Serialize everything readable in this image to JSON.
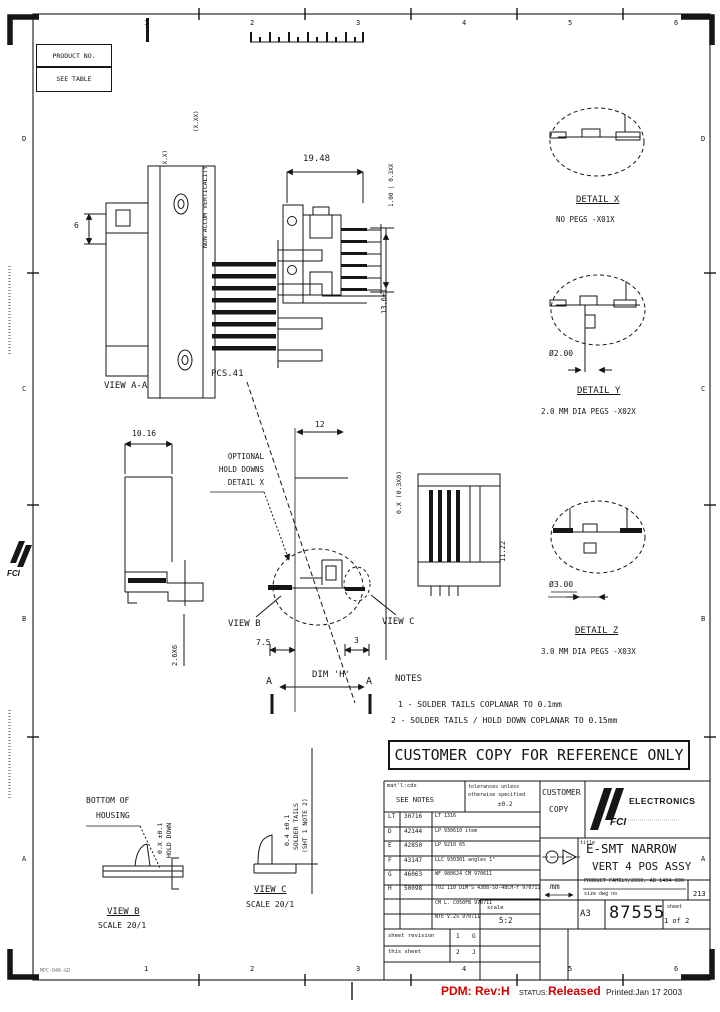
{
  "colors": {
    "ink": "#161616",
    "red": "#d40000"
  },
  "corner_boxes": {
    "product_no": "PRODUCT NO.",
    "see_table": "SEE TABLE"
  },
  "zones": {
    "top": [
      "1",
      "2",
      "3",
      "4",
      "5",
      "6"
    ],
    "bottom": [
      "1",
      "2",
      "3",
      "4",
      "5",
      "6"
    ],
    "left": [
      "D",
      "C",
      "B",
      "A"
    ],
    "right": [
      "D",
      "C",
      "B",
      "A"
    ]
  },
  "views": {
    "view_aa": {
      "label": "VIEW A-A",
      "pcs_label": "PCS.41",
      "dim_height": "6",
      "vdim_a": "(X.X)",
      "vdim_b": "(X.XX)",
      "vertical_note": "NON ACCUM VERTICALITY",
      "tail_dim": "0.X (0.3X0)"
    },
    "front": {
      "dim_width": "19.48",
      "vdim_top": "1.00 | 0.3XX",
      "vdim_side": "13.6±1"
    },
    "profile": {
      "dim_top": "10.16",
      "vdim_bottom": "2.6X6"
    },
    "section": {
      "dim_top": "12",
      "optional_1": "OPTIONAL",
      "optional_2": "HOLD DOWNS",
      "optional_3": "DETAIL X",
      "view_b_ref": "VIEW B",
      "view_c_ref": "VIEW C",
      "dim_left": "7.5",
      "dim_right": "3",
      "dim_h": "DIM 'H'",
      "section_letter": "A"
    },
    "right_view": {
      "vdim": "11.22"
    }
  },
  "details": [
    {
      "name": "DETAIL X",
      "sub": "NO PEGS  -X01X",
      "dim": ""
    },
    {
      "name": "DETAIL Y",
      "sub": "2.0 MM DIA PEGS -X02X",
      "dim": "Ø2.00"
    },
    {
      "name": "DETAIL Z",
      "sub": "3.0 MM DIA PEGS -X03X",
      "dim": "Ø3.00"
    }
  ],
  "notes": {
    "title": "NOTES",
    "items": [
      "1 - SOLDER TAILS COPLANAR TO 0.1mm",
      "2 - SOLDER TAILS / HOLD DOWN COPLANAR TO 0.15mm"
    ]
  },
  "banner": "CUSTOMER COPY FOR REFERENCE ONLY",
  "bottom_views": {
    "view_b": {
      "callout_1": "BOTTOM OF",
      "callout_2": "HOUSING",
      "vdim": "0.X ±0.1",
      "vlabel": "HOLD DOWN",
      "label": "VIEW B",
      "scale": "SCALE 20/1"
    },
    "view_c": {
      "vdim": "0.4 ±0.1",
      "vlabel_1": "SOLDER TAILS",
      "vlabel_2": "(SHT 1 NOTE 2)",
      "label": "VIEW C",
      "scale": "SCALE 20/1"
    }
  },
  "title_block": {
    "matl_label": "mat'l:cds",
    "see_notes": "SEE NOTES",
    "tol_1": "tolerances unless",
    "tol_2": "otherwise specified",
    "tol_value": "±0.2",
    "revisions": [
      {
        "ltr": "LT",
        "ecn": "30716",
        "desc": "LT 1316"
      },
      {
        "ltr": "D",
        "ecn": "42144",
        "desc": "LP 930610  item"
      },
      {
        "ltr": "E",
        "ecn": "42850",
        "desc": "LP 9210 65"
      },
      {
        "ltr": "F",
        "ecn": "43147",
        "desc": "LLC 930301  angles  1°"
      },
      {
        "ltr": "G",
        "ecn": "46063",
        "desc": "WF 980624 CM  970611"
      },
      {
        "ltr": "H",
        "ecn": "50098",
        "desc": "T02 110 DIM'S 4308-SO-48CH-F 970711"
      },
      {
        "ltr": "",
        "ecn": "",
        "desc": "CM  L. C050FB  970711"
      },
      {
        "ltr": "",
        "ecn": "",
        "desc": "NTE  V.2s  970711"
      }
    ],
    "customer_copy_1": "CUSTOMER",
    "customer_copy_2": "COPY",
    "logo_text": "FCI",
    "brand": "ELECTRONICS",
    "title_label": "title",
    "title_line1": "E-SMT NARROW",
    "title_line2": "VERT 4 POS ASSY",
    "units": "mm",
    "product_family": "PRODUCT FAMILY/2000, AB 1404 000",
    "size_dwg_label": "size dwg no",
    "size_dwg_value": "213",
    "scale_label": "scale",
    "scale_value": "5:2",
    "size": "A3",
    "drawing_number": "87555",
    "sheet_label": "sheet",
    "sheet_value": "1 of 2",
    "sheet_rev_rows": [
      {
        "label": "sheet  revision",
        "num": "1",
        "rev": "G"
      },
      {
        "label": "this  sheet",
        "num": "2",
        "rev": "J"
      }
    ]
  },
  "footer": {
    "form_no": "MPC-046-GD",
    "pdm": "PDM: Rev:H",
    "status_label": "STATUS:",
    "status_value": "Released",
    "printed": "Printed:Jan 17 2003"
  }
}
